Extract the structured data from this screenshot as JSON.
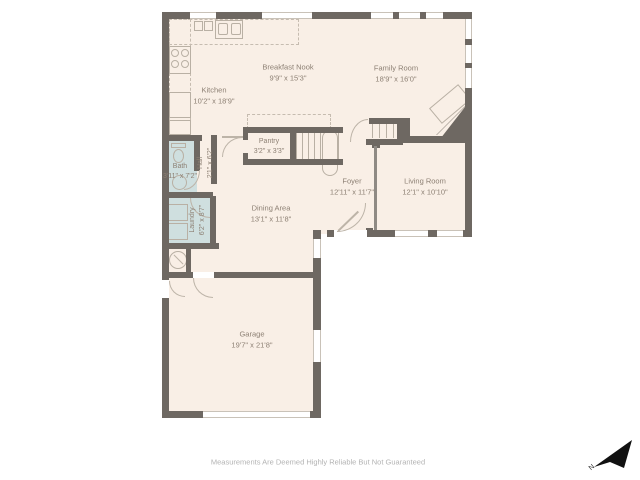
{
  "plan": {
    "rooms": {
      "kitchen": {
        "name": "Kitchen",
        "dims": "10'2\" x 18'9\""
      },
      "breakfast_nook": {
        "name": "Breakfast Nook",
        "dims": "9'9\" x 15'3\""
      },
      "family_room": {
        "name": "Family Room",
        "dims": "18'9\" x 16'0\""
      },
      "pantry": {
        "name": "Pantry",
        "dims": "3'2\" x 3'3\""
      },
      "hall": {
        "name": "Hall",
        "dims": "2'1\" x 6'2\""
      },
      "bath": {
        "name": "Bath",
        "dims": "3'11\" x 7'2\""
      },
      "laundry": {
        "name": "Laundry",
        "dims": "6'2\" x 8'7\""
      },
      "dining_area": {
        "name": "Dining Area",
        "dims": "13'1\" x 11'8\""
      },
      "foyer": {
        "name": "Foyer",
        "dims": "12'11\" x 11'7\""
      },
      "living_room": {
        "name": "Living Room",
        "dims": "12'1\" x 10'10\""
      },
      "garage": {
        "name": "Garage",
        "dims": "19'7\" x 21'8\""
      }
    },
    "colors": {
      "wall": "#6e6862",
      "floor": "#f9efe6",
      "wet_floor": "#cfdfdf",
      "fixture_line": "#b9b0a4",
      "label_text": "#8d8074",
      "compass": "#111111"
    },
    "compass": {
      "label": "N"
    },
    "footer": {
      "disclaimer": "Measurements Are Deemed Highly Reliable But Not Guaranteed"
    }
  }
}
